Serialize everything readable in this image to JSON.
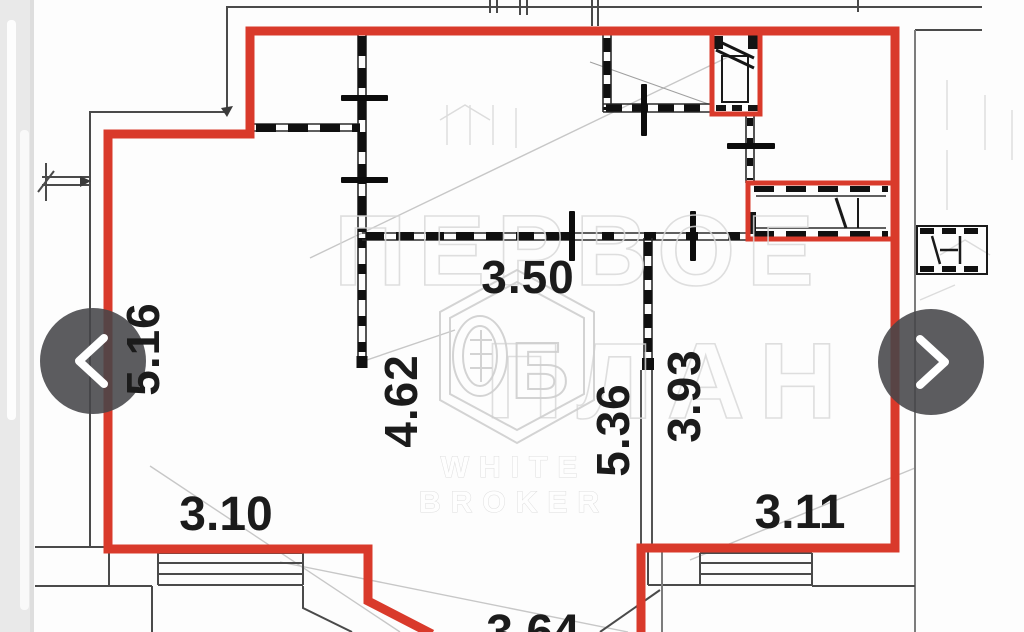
{
  "photo_viewer": {
    "prev_button": {
      "icon": "chevron-left-icon"
    },
    "next_button": {
      "icon": "chevron-right-icon"
    },
    "arrow_circle_color": "#454549",
    "arrow_glyph_color": "#ffffff"
  },
  "floor_plan": {
    "unit_outline_color": "#d93a2b",
    "wall_color": "#1a1a1a",
    "dimensions": {
      "left_room_height": "5.16",
      "left_room_width": "3.10",
      "hall_width": "3.50",
      "hall_height": "4.62",
      "center_room_height": "5.36",
      "right_room_height": "3.93",
      "right_room_width": "3.11",
      "bay_width": "3.64"
    },
    "watermark": {
      "background_text_line1": "ПЕРВОЕ",
      "background_text_line2": "ПЛАН",
      "logo_letter": "Б",
      "brand_line1": "WHITE",
      "brand_line2": "BROKER"
    }
  }
}
